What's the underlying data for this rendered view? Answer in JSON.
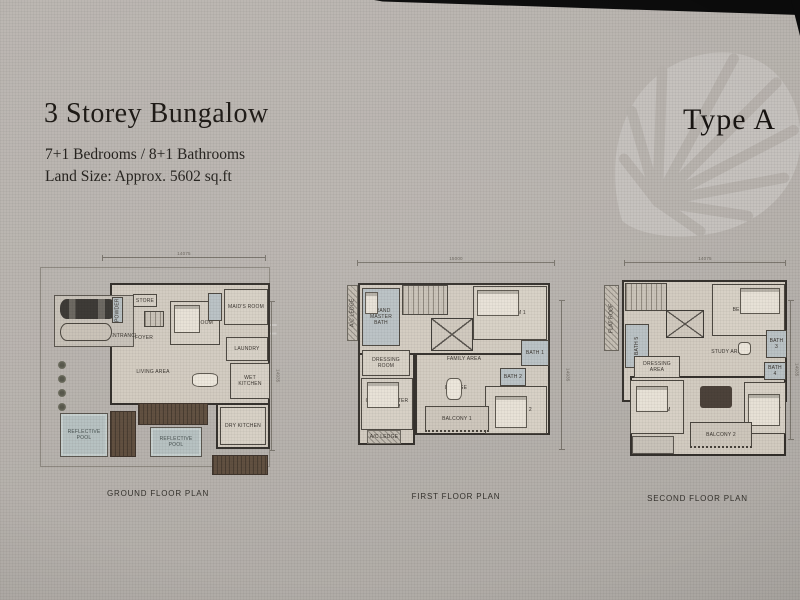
{
  "header": {
    "title": "3 Storey Bungalow",
    "bedrooms_line": "7+1 Bedrooms / 8+1 Bathrooms",
    "land_line": "Land Size: Approx. 5602 sq.ft",
    "type_label": "Type A"
  },
  "watermark_letters": [
    {
      "ch": "F",
      "x": 262,
      "y": 318
    },
    {
      "ch": "C",
      "x": 383,
      "y": 323
    },
    {
      "ch": "N",
      "x": 478,
      "y": 327
    },
    {
      "ch": "G",
      "x": 508,
      "y": 329
    }
  ],
  "plans": [
    {
      "caption": "GROUND FLOOR PLAN",
      "shapes": [
        {
          "t": "dimh",
          "l": "14075",
          "x": 64,
          "y": 4,
          "w": 164,
          "h": 1
        },
        {
          "t": "dimv",
          "l": "14935",
          "x": 233,
          "y": 48,
          "w": 1,
          "h": 150
        },
        {
          "t": "boundary",
          "x": 2,
          "y": 14,
          "w": 230,
          "h": 200,
          "n": "property-boundary"
        },
        {
          "t": "shell",
          "x": 72,
          "y": 30,
          "w": 160,
          "h": 122,
          "n": "house-outline"
        },
        {
          "t": "shell",
          "x": 178,
          "y": 150,
          "w": 54,
          "h": 46,
          "n": "kitchen-wing-outline"
        },
        {
          "t": "porch",
          "x": 16,
          "y": 42,
          "w": 80,
          "h": 52,
          "n": "car-porch"
        },
        {
          "t": "car",
          "x": 22,
          "y": 46,
          "w": 56,
          "h": 20,
          "n": "car-1"
        },
        {
          "t": "car2",
          "x": 22,
          "y": 70,
          "w": 52,
          "h": 18,
          "n": "car-2"
        },
        {
          "t": "bath",
          "l": "POWDER",
          "v": true,
          "x": 74,
          "y": 44,
          "w": 11,
          "h": 26
        },
        {
          "t": "room",
          "l": "STORE",
          "x": 95,
          "y": 41,
          "w": 24,
          "h": 13
        },
        {
          "t": "stairs",
          "x": 106,
          "y": 58,
          "w": 20,
          "h": 16,
          "n": "stairs"
        },
        {
          "t": "open",
          "l": "FOYER",
          "x": 90,
          "y": 78,
          "w": 32,
          "h": 14
        },
        {
          "t": "room",
          "l": "GUEST ROOM",
          "x": 132,
          "y": 48,
          "w": 50,
          "h": 44
        },
        {
          "t": "bed",
          "x": 136,
          "y": 52,
          "w": 26,
          "h": 28,
          "n": "guest-bed"
        },
        {
          "t": "bath",
          "x": 170,
          "y": 40,
          "w": 14,
          "h": 28,
          "n": "guest-bath"
        },
        {
          "t": "room",
          "l": "MAID'S ROOM",
          "x": 186,
          "y": 36,
          "w": 44,
          "h": 36
        },
        {
          "t": "room",
          "l": "LAUNDRY",
          "x": 188,
          "y": 84,
          "w": 42,
          "h": 24
        },
        {
          "t": "open",
          "l": "ENTRANCE",
          "x": 74,
          "y": 74,
          "w": 24,
          "h": 18
        },
        {
          "t": "open",
          "l": "LIVING AREA",
          "x": 90,
          "y": 100,
          "w": 50,
          "h": 38
        },
        {
          "t": "open",
          "l": "DINING",
          "x": 146,
          "y": 116,
          "w": 44,
          "h": 30
        },
        {
          "t": "table",
          "x": 154,
          "y": 120,
          "w": 26,
          "h": 14,
          "n": "dining-table"
        },
        {
          "t": "room",
          "l": "WET KITCHEN",
          "x": 192,
          "y": 110,
          "w": 40,
          "h": 36
        },
        {
          "t": "room",
          "l": "DRY KITCHEN",
          "x": 182,
          "y": 154,
          "w": 46,
          "h": 38
        },
        {
          "t": "plant",
          "x": 20,
          "y": 108
        },
        {
          "t": "plant",
          "x": 20,
          "y": 122
        },
        {
          "t": "plant",
          "x": 20,
          "y": 136
        },
        {
          "t": "plant",
          "x": 20,
          "y": 150
        },
        {
          "t": "pool",
          "l": "REFLECTIVE POOL",
          "x": 22,
          "y": 160,
          "w": 48,
          "h": 44
        },
        {
          "t": "deck",
          "x": 72,
          "y": 158,
          "w": 26,
          "h": 46,
          "n": "timber-deck"
        },
        {
          "t": "deck",
          "x": 100,
          "y": 150,
          "w": 70,
          "h": 22,
          "n": "timber-deck"
        },
        {
          "t": "pool",
          "l": "REFLECTIVE POOL",
          "x": 112,
          "y": 174,
          "w": 52,
          "h": 30
        },
        {
          "t": "deck",
          "x": 174,
          "y": 202,
          "w": 56,
          "h": 20,
          "n": "timber-deck"
        }
      ]
    },
    {
      "caption": "FIRST FLOOR PLAN",
      "shapes": [
        {
          "t": "dimh",
          "l": "15000",
          "x": 12,
          "y": 4,
          "w": 198,
          "h": 1
        },
        {
          "t": "dimv",
          "l": "14935",
          "x": 216,
          "y": 42,
          "w": 1,
          "h": 150
        },
        {
          "t": "shell",
          "x": 13,
          "y": 25,
          "w": 192,
          "h": 95,
          "n": "upper-block"
        },
        {
          "t": "shell",
          "x": 13,
          "y": 95,
          "w": 57,
          "h": 92,
          "n": "master-wing"
        },
        {
          "t": "shell",
          "x": 70,
          "y": 95,
          "w": 135,
          "h": 82,
          "n": "lower-block"
        },
        {
          "t": "hatch",
          "l": "A/C LEDGE",
          "v": true,
          "x": 2,
          "y": 27,
          "w": 11,
          "h": 56
        },
        {
          "t": "bath",
          "l": "GRAND MASTER BATH",
          "x": 17,
          "y": 30,
          "w": 38,
          "h": 58
        },
        {
          "t": "bed",
          "x": 20,
          "y": 34,
          "w": 13,
          "h": 22,
          "n": "bathtub"
        },
        {
          "t": "stairs",
          "x": 57,
          "y": 27,
          "w": 46,
          "h": 30,
          "n": "stairs"
        },
        {
          "t": "void",
          "x": 86,
          "y": 60,
          "w": 42,
          "h": 33,
          "n": "void-skylight"
        },
        {
          "t": "room",
          "l": "BEDROOM 1",
          "x": 128,
          "y": 28,
          "w": 74,
          "h": 54
        },
        {
          "t": "bed",
          "x": 132,
          "y": 32,
          "w": 42,
          "h": 26,
          "n": "bed"
        },
        {
          "t": "open",
          "l": "FAMILY AREA",
          "x": 78,
          "y": 75,
          "w": 82,
          "h": 52
        },
        {
          "t": "room",
          "l": "DRESSING ROOM",
          "x": 17,
          "y": 92,
          "w": 48,
          "h": 26
        },
        {
          "t": "room",
          "l": "GRAND MASTER BEDROOM",
          "x": 16,
          "y": 120,
          "w": 52,
          "h": 52
        },
        {
          "t": "bed",
          "x": 22,
          "y": 124,
          "w": 32,
          "h": 26,
          "n": "bed"
        },
        {
          "t": "open",
          "l": "LOUNGE",
          "x": 88,
          "y": 112,
          "w": 46,
          "h": 36
        },
        {
          "t": "table",
          "x": 101,
          "y": 120,
          "w": 16,
          "h": 22,
          "n": "lounge-table"
        },
        {
          "t": "bath",
          "l": "BATH 2",
          "x": 155,
          "y": 110,
          "w": 26,
          "h": 18
        },
        {
          "t": "bath",
          "l": "BATH 1",
          "x": 176,
          "y": 82,
          "w": 28,
          "h": 26
        },
        {
          "t": "room",
          "l": "BEDROOM 2",
          "x": 140,
          "y": 128,
          "w": 62,
          "h": 48
        },
        {
          "t": "bed",
          "x": 150,
          "y": 138,
          "w": 32,
          "h": 32,
          "n": "bed"
        },
        {
          "t": "hatch",
          "l": "A/C LEDGE",
          "x": 22,
          "y": 172,
          "w": 34,
          "h": 14
        },
        {
          "t": "balcony",
          "l": "BALCONY 1",
          "x": 80,
          "y": 148,
          "w": 64,
          "h": 26
        }
      ]
    },
    {
      "caption": "SECOND FLOOR PLAN",
      "shapes": [
        {
          "t": "dimh",
          "l": "14075",
          "x": 24,
          "y": 4,
          "w": 162,
          "h": 1
        },
        {
          "t": "dimv",
          "l": "14935",
          "x": 190,
          "y": 42,
          "w": 1,
          "h": 140
        },
        {
          "t": "hatch",
          "l": "FLAT ROOF",
          "v": true,
          "x": 4,
          "y": 27,
          "w": 15,
          "h": 66
        },
        {
          "t": "shell",
          "x": 22,
          "y": 22,
          "w": 165,
          "h": 122,
          "n": "upper-block"
        },
        {
          "t": "shell",
          "x": 30,
          "y": 118,
          "w": 156,
          "h": 80,
          "n": "lower-block"
        },
        {
          "t": "stairs",
          "x": 25,
          "y": 25,
          "w": 42,
          "h": 28,
          "n": "stairs"
        },
        {
          "t": "void",
          "x": 66,
          "y": 52,
          "w": 38,
          "h": 28,
          "n": "void-skylight"
        },
        {
          "t": "bath",
          "l": "BATH 5",
          "v": true,
          "x": 25,
          "y": 66,
          "w": 24,
          "h": 44
        },
        {
          "t": "room",
          "l": "BEDROOM 3",
          "x": 112,
          "y": 26,
          "w": 73,
          "h": 52
        },
        {
          "t": "bed",
          "x": 140,
          "y": 30,
          "w": 40,
          "h": 26,
          "n": "bed"
        },
        {
          "t": "open",
          "l": "STUDY AREA",
          "x": 92,
          "y": 74,
          "w": 72,
          "h": 40
        },
        {
          "t": "table",
          "x": 138,
          "y": 84,
          "w": 13,
          "h": 13,
          "n": "study-table"
        },
        {
          "t": "bath",
          "l": "BATH 3",
          "x": 166,
          "y": 72,
          "w": 21,
          "h": 28
        },
        {
          "t": "room",
          "l": "DRESSING AREA",
          "x": 34,
          "y": 98,
          "w": 46,
          "h": 22
        },
        {
          "t": "room",
          "l": "MASTER BEDROOM",
          "x": 30,
          "y": 122,
          "w": 54,
          "h": 54
        },
        {
          "t": "bed",
          "x": 36,
          "y": 128,
          "w": 32,
          "h": 26,
          "n": "bed"
        },
        {
          "t": "open",
          "l": "AV ROOM",
          "x": 92,
          "y": 116,
          "w": 56,
          "h": 46
        },
        {
          "t": "sofa",
          "x": 100,
          "y": 128,
          "w": 32,
          "h": 22,
          "n": "av-sofa"
        },
        {
          "t": "bath",
          "l": "BATH 4",
          "x": 164,
          "y": 104,
          "w": 22,
          "h": 18
        },
        {
          "t": "room",
          "l": "BEDROOM 4",
          "x": 144,
          "y": 124,
          "w": 42,
          "h": 52
        },
        {
          "t": "bed",
          "x": 148,
          "y": 136,
          "w": 32,
          "h": 32,
          "n": "bed"
        },
        {
          "t": "balcony",
          "l": "BALCONY 2",
          "x": 90,
          "y": 164,
          "w": 62,
          "h": 26
        },
        {
          "t": "porch",
          "x": 32,
          "y": 178,
          "w": 42,
          "h": 18,
          "n": "terrace"
        }
      ]
    }
  ]
}
